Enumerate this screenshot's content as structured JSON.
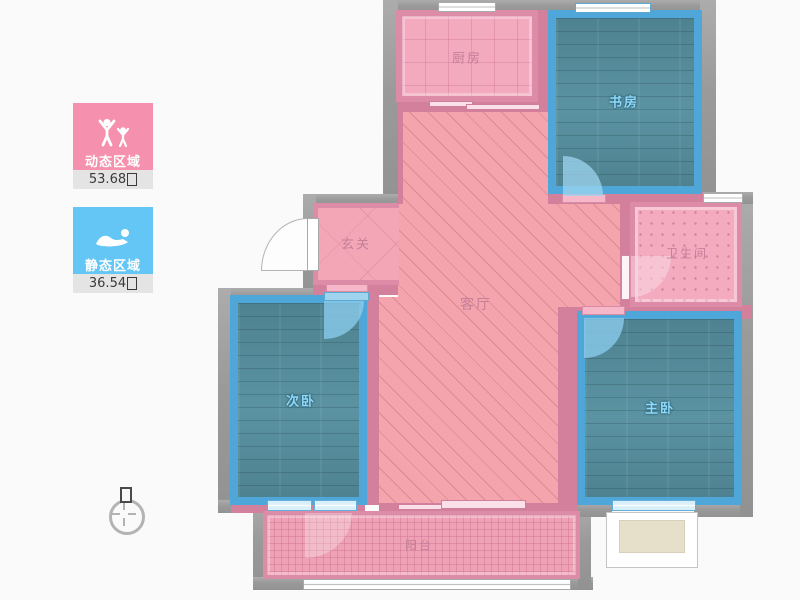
{
  "legend": {
    "dynamic": {
      "label": "动态区域",
      "value": "53.68",
      "unit_glyph": "tofu-box",
      "color": "#F590AE"
    },
    "static": {
      "label": "静态区域",
      "value": "36.54",
      "unit_glyph": "tofu-box",
      "color": "#63C6F5"
    }
  },
  "compass": {
    "north_glyph": "tofu-box"
  },
  "rooms": {
    "kitchen": {
      "label": "厨房"
    },
    "study": {
      "label": "书房"
    },
    "hallway": {
      "label": "玄关"
    },
    "living": {
      "label": "客厅"
    },
    "bathroom": {
      "label": "卫生间"
    },
    "bedroom2": {
      "label": "次卧"
    },
    "master": {
      "label": "主卧"
    },
    "balcony": {
      "label": "阳台"
    }
  },
  "colors": {
    "outer_wall": "#9A9A9A",
    "inner_wall": "#D2809C",
    "teal_wall": "#4FA6D9",
    "pink_floor": "#F4A4AC",
    "wood_floor": "#54879A",
    "legend_pink": "#F590AE",
    "legend_blue": "#63C6F5",
    "background": "#FAFAFA"
  }
}
